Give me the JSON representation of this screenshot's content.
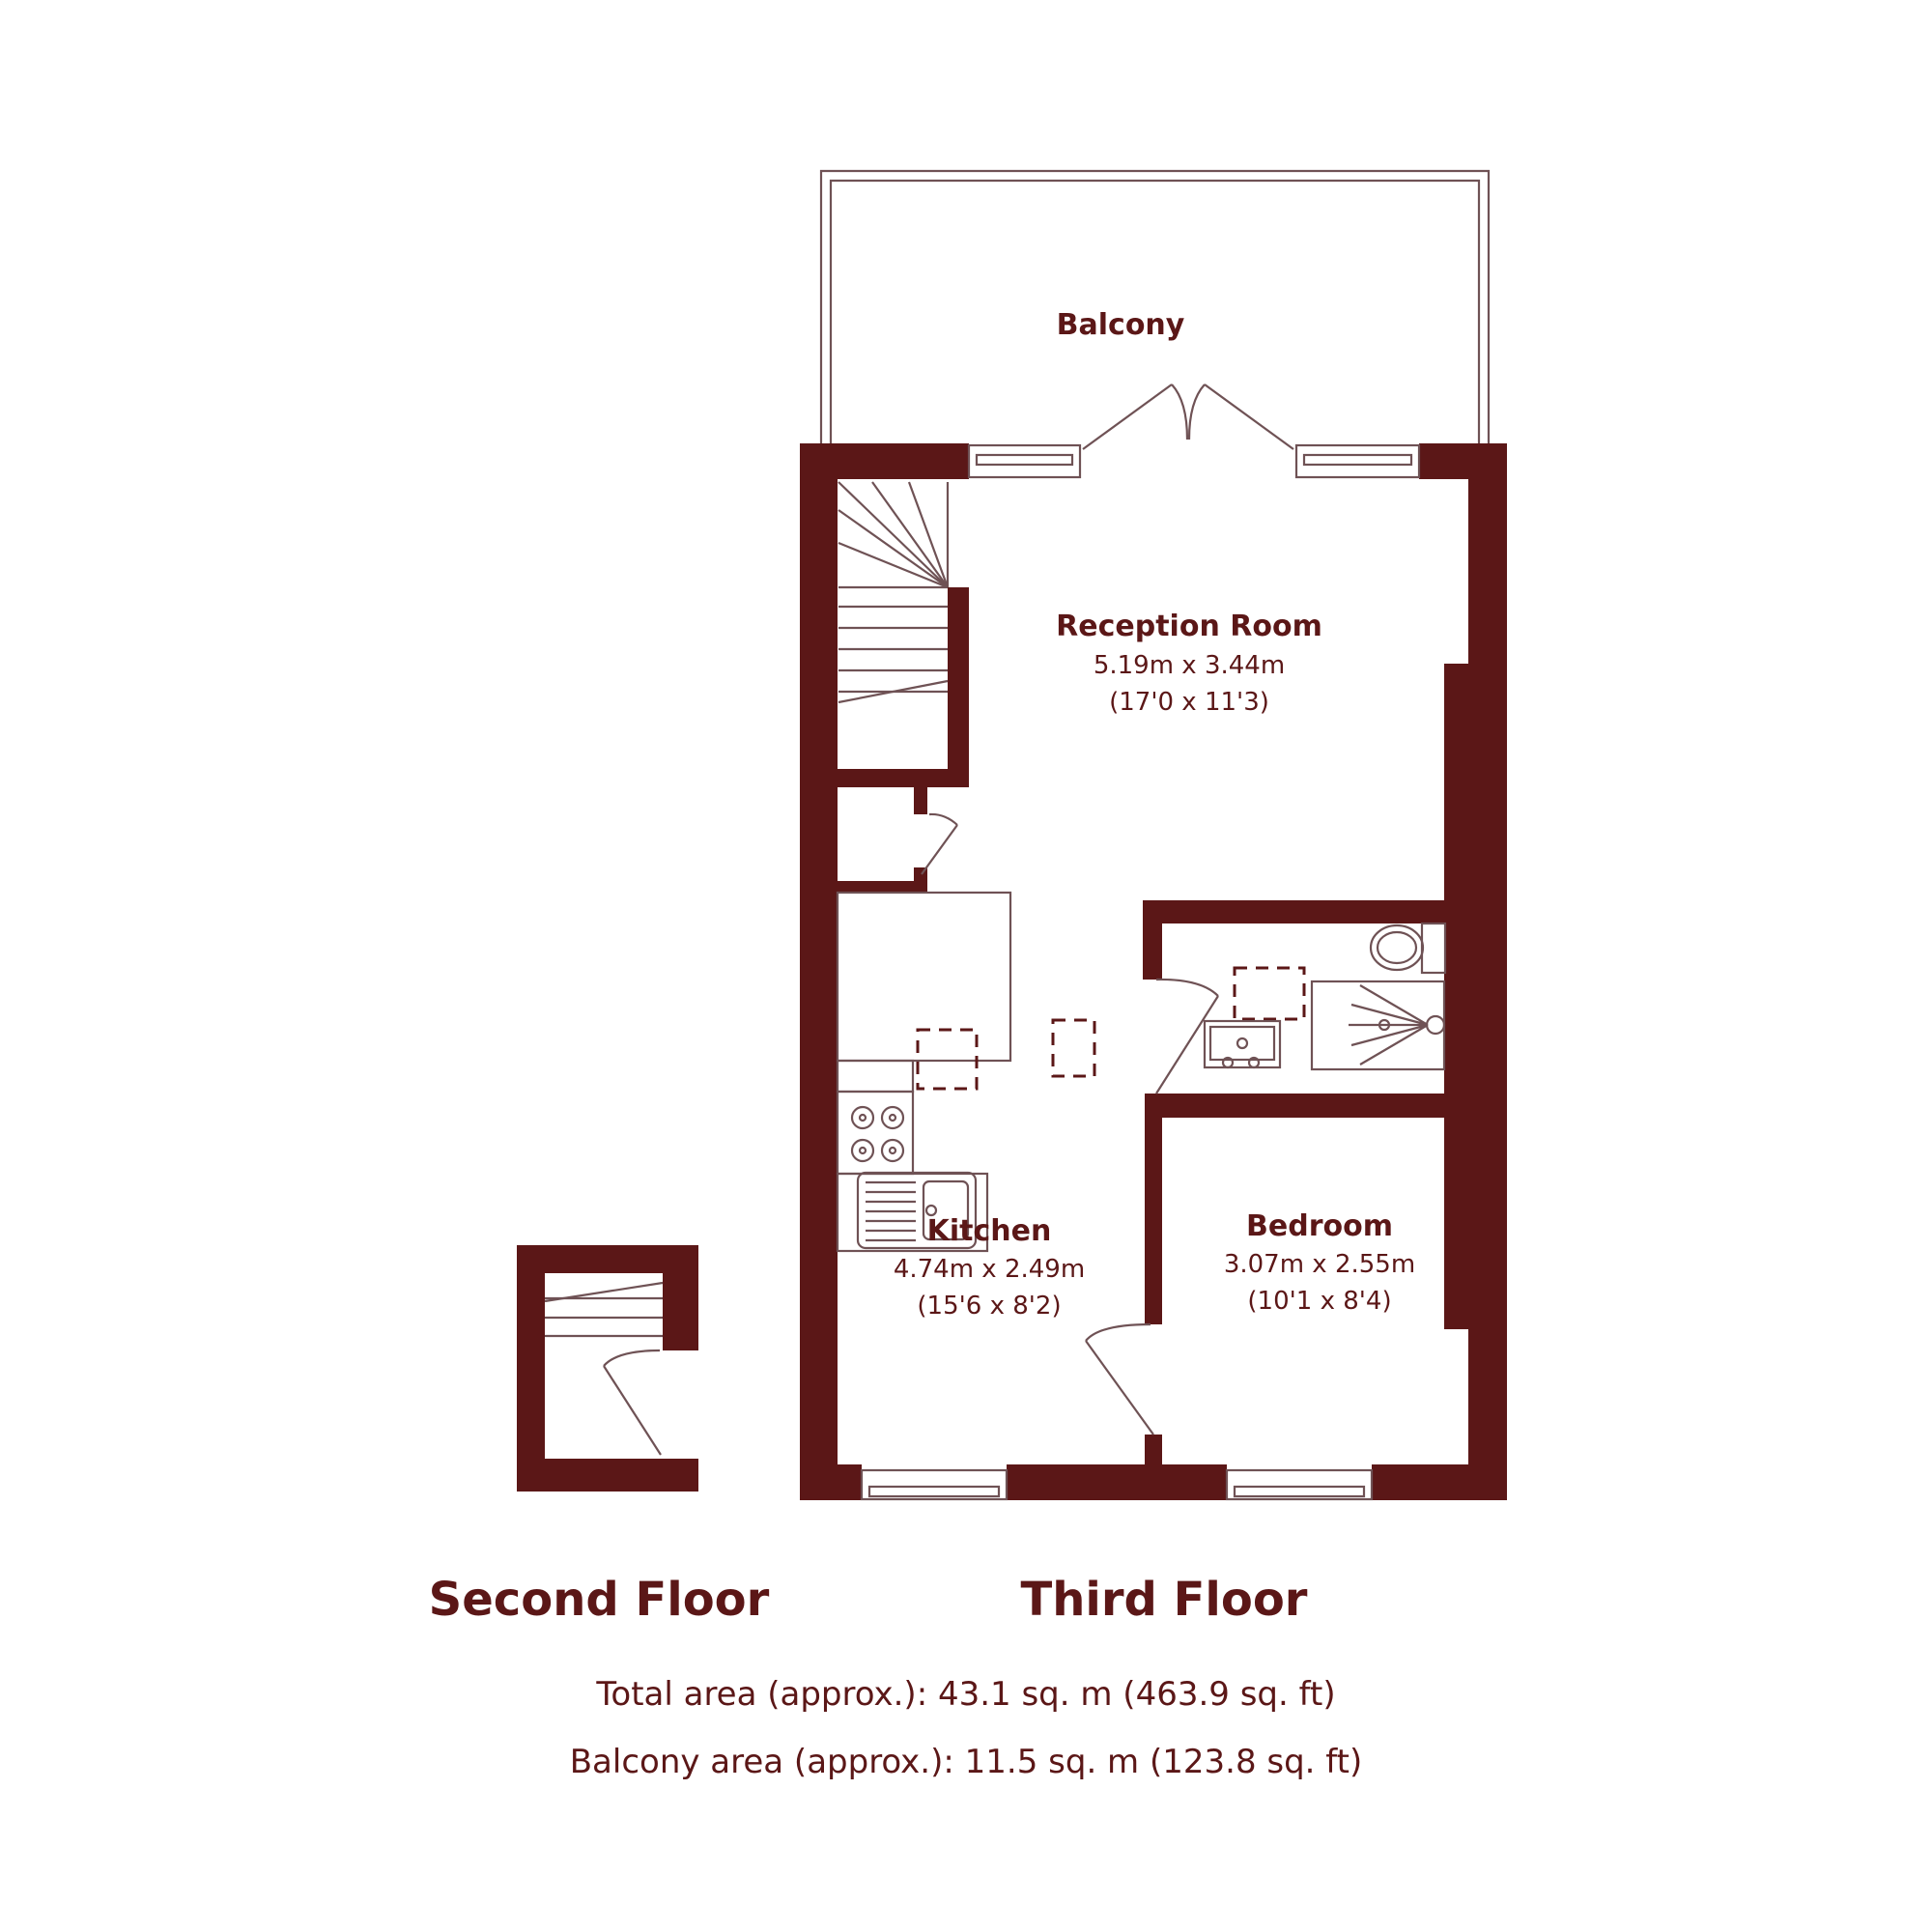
{
  "colors": {
    "wall": "#5B1717",
    "thin_line": "#6F5255",
    "text": "#5B1717",
    "background": "#FFFFFF"
  },
  "rooms": {
    "balcony": {
      "name": "Balcony"
    },
    "reception": {
      "name": "Reception Room",
      "dim_metric": "5.19m x 3.44m",
      "dim_imperial": "(17'0 x 11'3)"
    },
    "kitchen": {
      "name": "Kitchen",
      "dim_metric": "4.74m x 2.49m",
      "dim_imperial": "(15'6 x 8'2)"
    },
    "bedroom": {
      "name": "Bedroom",
      "dim_metric": "3.07m x 2.55m",
      "dim_imperial": "(10'1 x 8'4)"
    }
  },
  "floors": {
    "second": {
      "label": "Second Floor"
    },
    "third": {
      "label": "Third Floor"
    }
  },
  "summary": {
    "total_area": "Total area (approx.): 43.1 sq. m (463.9 sq. ft)",
    "balcony_area": "Balcony area (approx.): 11.5 sq. m (123.8 sq. ft)"
  },
  "fixtures": [
    "staircase",
    "french-doors",
    "window",
    "door",
    "kitchen-counter",
    "hob",
    "kitchen-sink",
    "appliance-space",
    "toilet",
    "washbasin",
    "shower"
  ]
}
